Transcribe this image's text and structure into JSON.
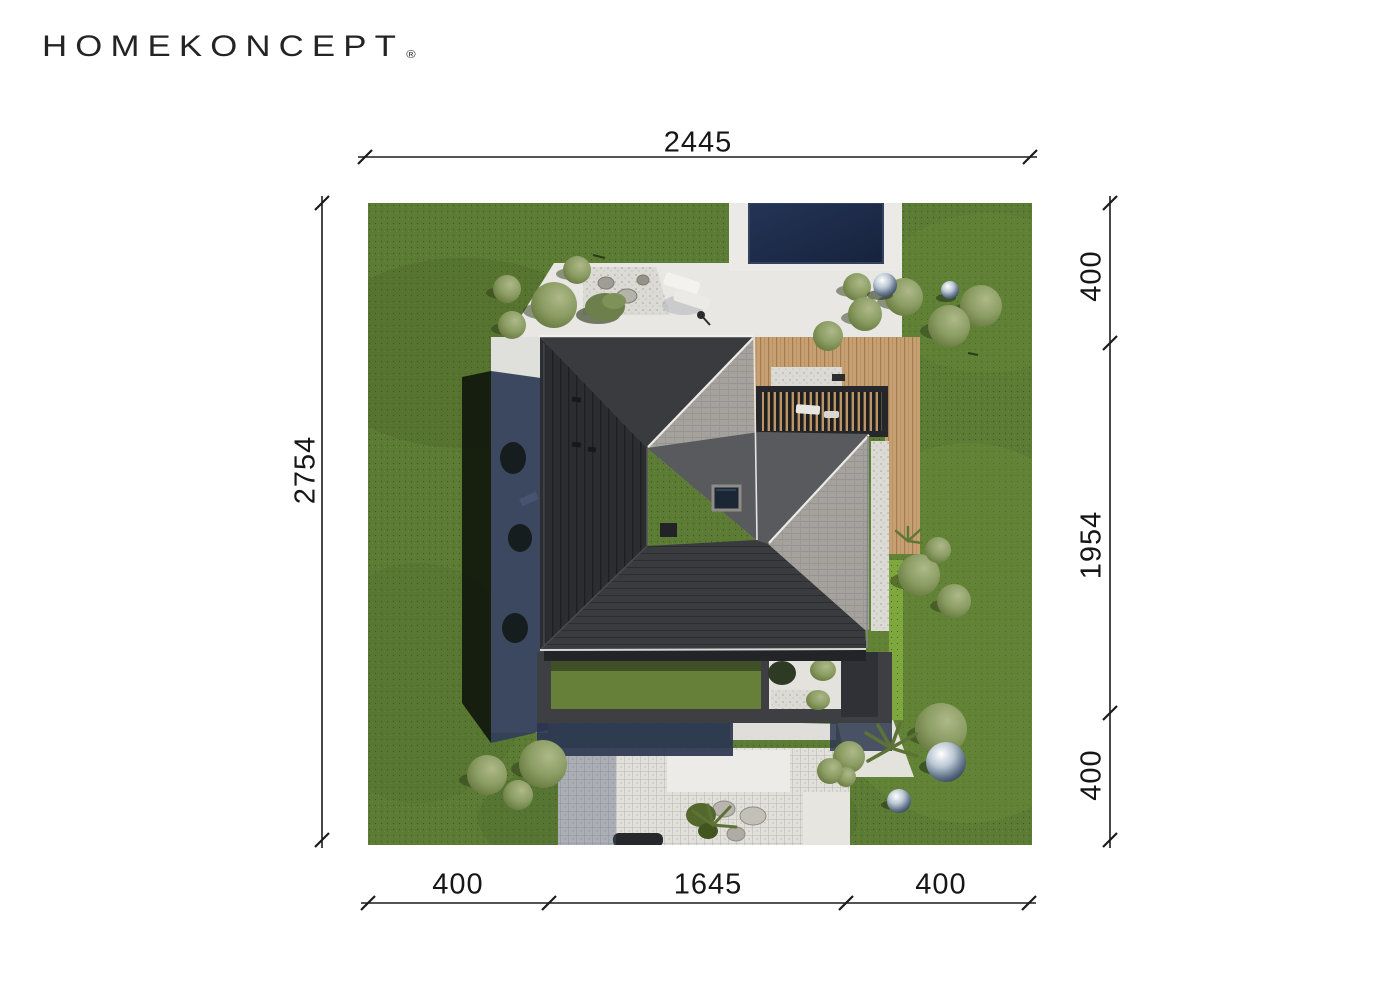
{
  "brand": {
    "logo_text": "HOMEKONCEPT",
    "registered_mark": "®"
  },
  "dimensions": {
    "top": {
      "value": "2445"
    },
    "left": {
      "value": "2754"
    },
    "right": {
      "segments": [
        "400",
        "1954",
        "400"
      ]
    },
    "bottom": {
      "segments": [
        "400",
        "1645",
        "400"
      ]
    }
  },
  "scene": {
    "alt": "Aerial render of plot: hip-roofed house with wooden terrace, pergola, pool, gravel paths and garden"
  },
  "colors": {
    "grass": "#5c7b34",
    "patio": "#e8e7e3",
    "pool": "#1c2a48",
    "deck": "#c7a072",
    "roof_dark": "#2d2e31",
    "roof_dark2": "#3a3b3e",
    "roof_mid": "#595a5d",
    "roof_light": "#a5a29e",
    "hedge": "#7ea73e",
    "frame": "#3e3f43",
    "gravel": "#d9d7d1",
    "shadow_blue": "#333f59",
    "shadow_grass": "#131a0e",
    "courtyard_grass": "#66803a",
    "dim_line": "#1b1b1b"
  }
}
